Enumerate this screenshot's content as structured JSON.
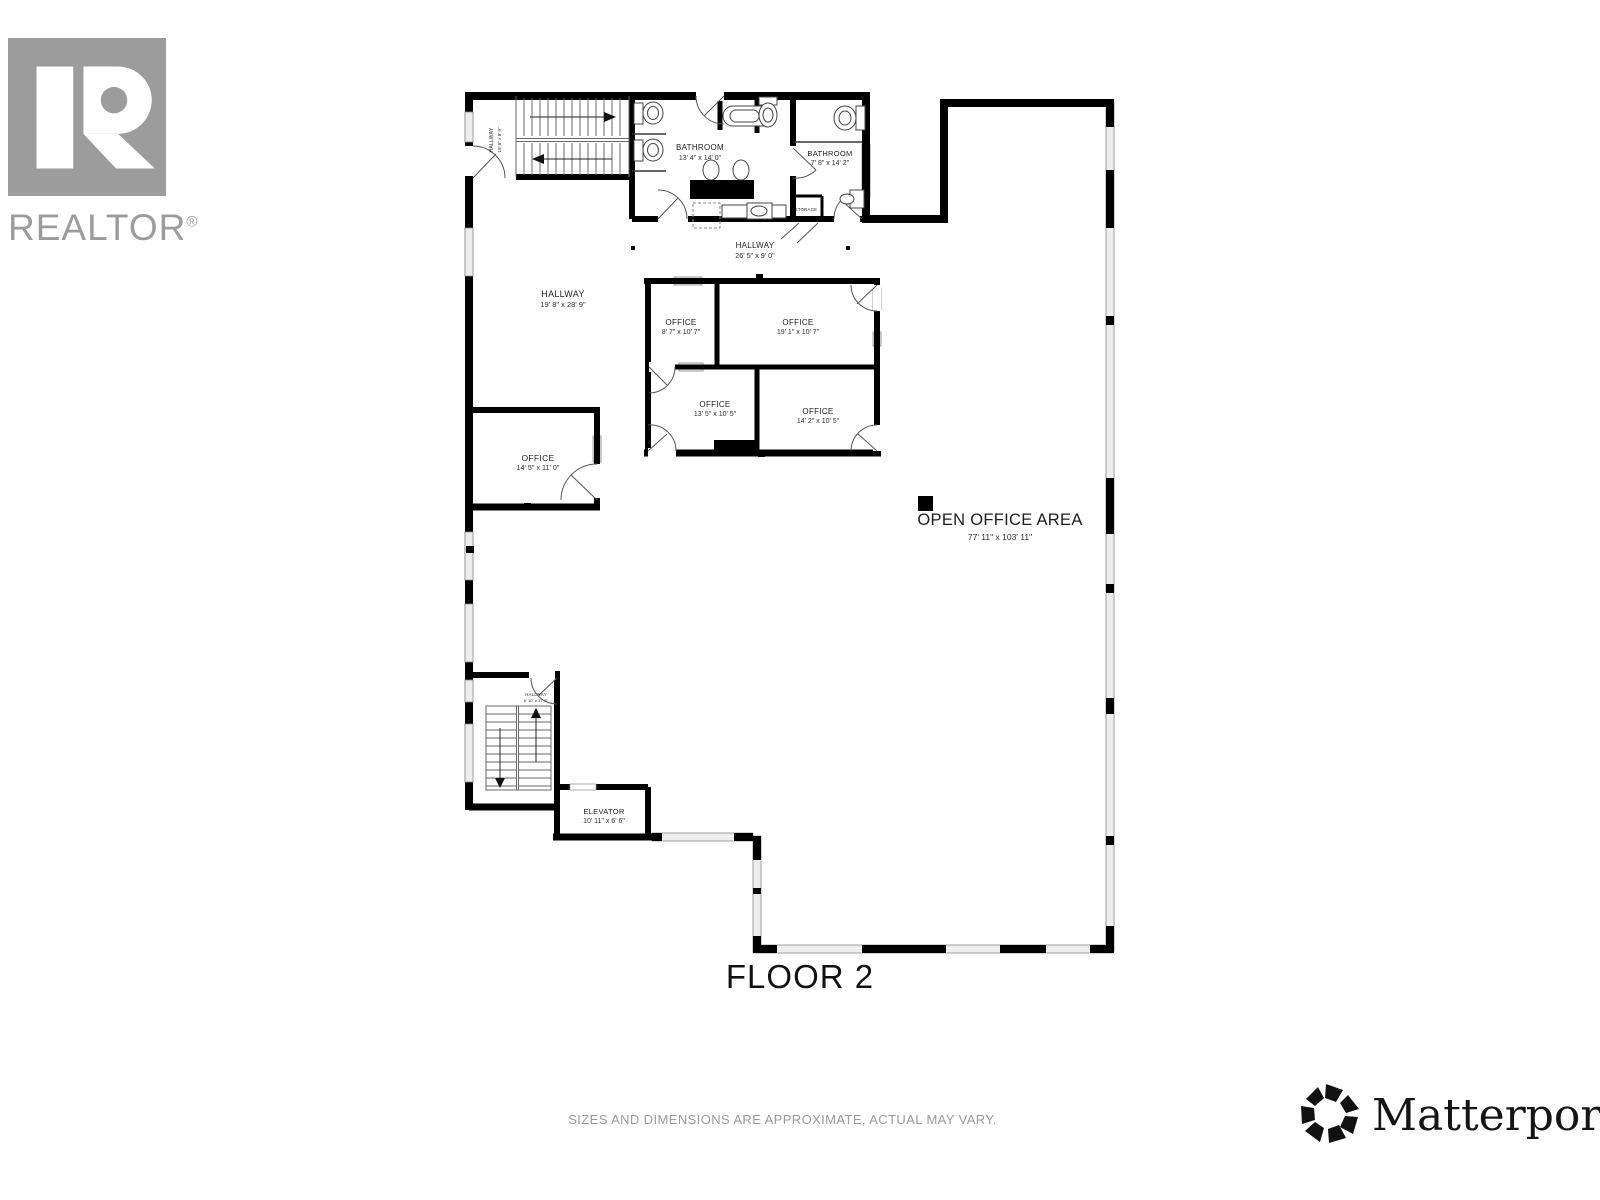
{
  "branding": {
    "realtor_text": "REALTOR",
    "realtor_reg": "®",
    "matterport_text": "Matterport",
    "matterport_reg": "®"
  },
  "floor": {
    "title": "FLOOR 2"
  },
  "footer": {
    "disclaimer": "SIZES AND DIMENSIONS ARE APPROXIMATE, ACTUAL MAY VARY."
  },
  "rooms": [
    {
      "name": "HALLWAY",
      "dims": "19' 8\" x 8' 9\""
    },
    {
      "name": "BATHROOM",
      "dims": "13' 4\" x 14' 0\""
    },
    {
      "name": "BATHROOM",
      "dims": "7' 8\" x 14' 2\""
    },
    {
      "name": "STORAGE",
      "dims": ""
    },
    {
      "name": "HALLWAY",
      "dims": "26' 5\" x 9' 0\""
    },
    {
      "name": "HALLWAY",
      "dims": "19' 8\" x 28' 9\""
    },
    {
      "name": "OFFICE",
      "dims": "8' 7\" x 10' 7\""
    },
    {
      "name": "OFFICE",
      "dims": "19' 1\" x 10' 7\""
    },
    {
      "name": "OFFICE",
      "dims": "13' 5\" x 10' 5\""
    },
    {
      "name": "OFFICE",
      "dims": "14' 2\" x 10' 5\""
    },
    {
      "name": "OFFICE",
      "dims": "14' 5\" x 11' 0\""
    },
    {
      "name": "OPEN OFFICE AREA",
      "dims": "77' 11\" x 103' 11\""
    },
    {
      "name": "HALLWAY",
      "dims": "6' 10\" x 17' 8\""
    },
    {
      "name": "ELEVATOR",
      "dims": "10' 11\" x 6' 6\""
    }
  ]
}
